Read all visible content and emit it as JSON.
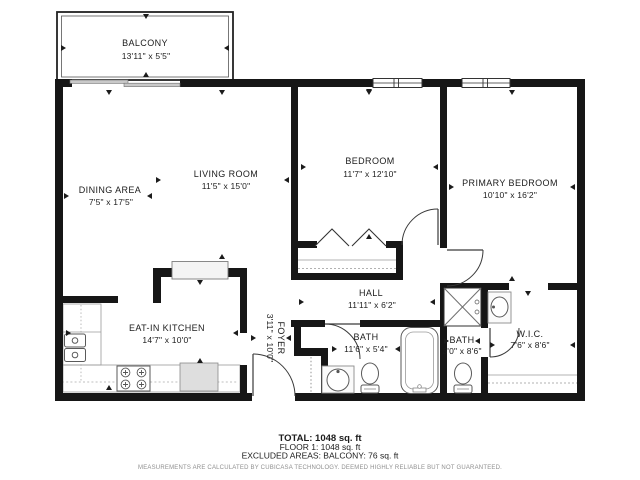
{
  "floorplan": {
    "balcony": {
      "name": "BALCONY",
      "dims": "13'11\" x 5'5\""
    },
    "dining": {
      "name": "DINING AREA",
      "dims": "7'5\" x 17'5\""
    },
    "living": {
      "name": "LIVING ROOM",
      "dims": "11'5\" x 15'0\""
    },
    "bedroom": {
      "name": "BEDROOM",
      "dims": "11'7\" x 12'10\""
    },
    "primary": {
      "name": "PRIMARY BEDROOM",
      "dims": "10'10\" x 16'2\""
    },
    "kitchen": {
      "name": "EAT-IN KITCHEN",
      "dims": "14'7\" x 10'0\""
    },
    "hall": {
      "name": "HALL",
      "dims": "11'11\" x 6'2\""
    },
    "foyer": {
      "name": "FOYER",
      "dims": "3'11\" x 10'0\""
    },
    "bath1": {
      "name": "BATH",
      "dims": "11'6\" x 5'4\""
    },
    "bath2": {
      "name": "BATH",
      "dims": "3'0\" x 8'6\""
    },
    "wic": {
      "name": "W.I.C.",
      "dims": "7'6\" x 8'6\""
    }
  },
  "summary": {
    "total": "TOTAL: 1048 sq. ft",
    "floor": "FLOOR 1: 1048 sq. ft",
    "excluded": "EXCLUDED AREAS: BALCONY: 76 sq. ft",
    "disclaimer": "MEASUREMENTS ARE CALCULATED BY CUBICASA TECHNOLOGY. DEEMED HIGHLY RELIABLE BUT NOT GUARANTEED."
  },
  "colors": {
    "wall": "#161616",
    "fixture_outline": "#5a5a5a",
    "appliance_fill": "#dedede",
    "disclaimer_text": "#8f8f8f",
    "background": "#ffffff"
  }
}
